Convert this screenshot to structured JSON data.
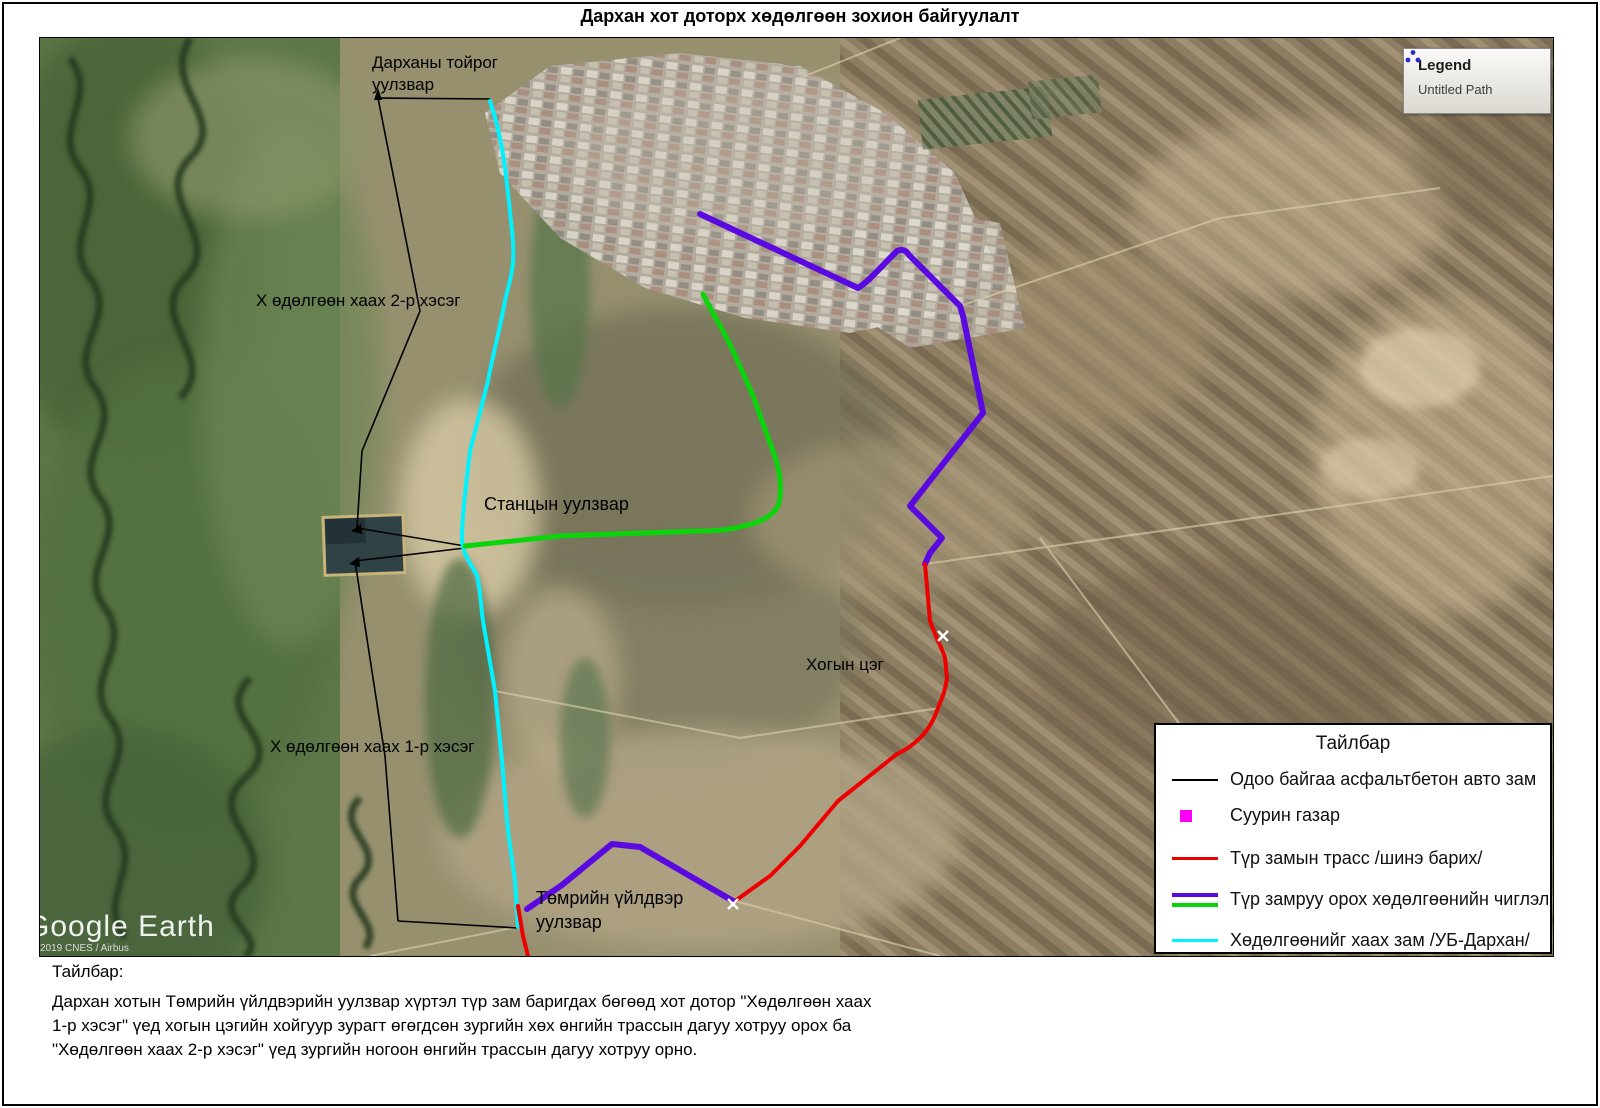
{
  "title": "Дархан хот доторх хөдөлгөөн зохион байгуулалт",
  "map": {
    "legend_box": {
      "title": "Legend",
      "item": "Untitled Path"
    },
    "labels": {
      "ring_line1": "Дарханы тойрог",
      "ring_line2": "уулзвар",
      "close_2": "Х өдөлгөөн хаах 2-р хэсэг",
      "station": "Станцын уулзвар",
      "dump": "Хогын цэг",
      "close_1": "Х өдөлгөөн хаах 1-р хэсэг",
      "iron_line1": "Төмрийн үйлдвэр",
      "iron_line2": "уулзвар"
    },
    "watermark": "Google Earth",
    "copyright": "2019 CNES / Airbus"
  },
  "legend": {
    "title": "Тайлбар",
    "items": [
      {
        "label": "Одоо байгаа асфальтбетон авто зам",
        "swatch": "line",
        "color_key": "black"
      },
      {
        "label": "Суурин газар",
        "swatch": "square",
        "color_key": "magenta"
      },
      {
        "label": "Түр замын трасс /шинэ барих/",
        "swatch": "line",
        "color_key": "red"
      },
      {
        "label": "Түр замруу орох хөдөлгөөнийн чиглэл",
        "swatch": "double",
        "color_key": "purple_green"
      },
      {
        "label": "Хөдөлгөөнийг хаах зам /УБ-Дархан/",
        "swatch": "line",
        "color_key": "cyan"
      }
    ]
  },
  "note": {
    "heading": "Тайлбар:",
    "body": "Дархан хотын Төмрийн үйлдвэрийн уулзвар хүртэл түр зам баригдах бөгөөд хот дотор \"Хөдөлгөөн хаах 1-р хэсэг\" үед хогын цэгийн хойгуур зурагт өгөгдсөн зургийн хөх өнгийн трассын дагуу хотруу орох ба \"Хөдөлгөөн хаах 2-р хэсэг\" үед зургийн ногоон өнгийн трассын дагуу хотруу орно."
  },
  "colors": {
    "black": "#000000",
    "magenta": "#ff00ff",
    "red": "#ee0000",
    "purple": "#5a0ae0",
    "green": "#0ad50a",
    "cyan": "#00f2ff"
  }
}
